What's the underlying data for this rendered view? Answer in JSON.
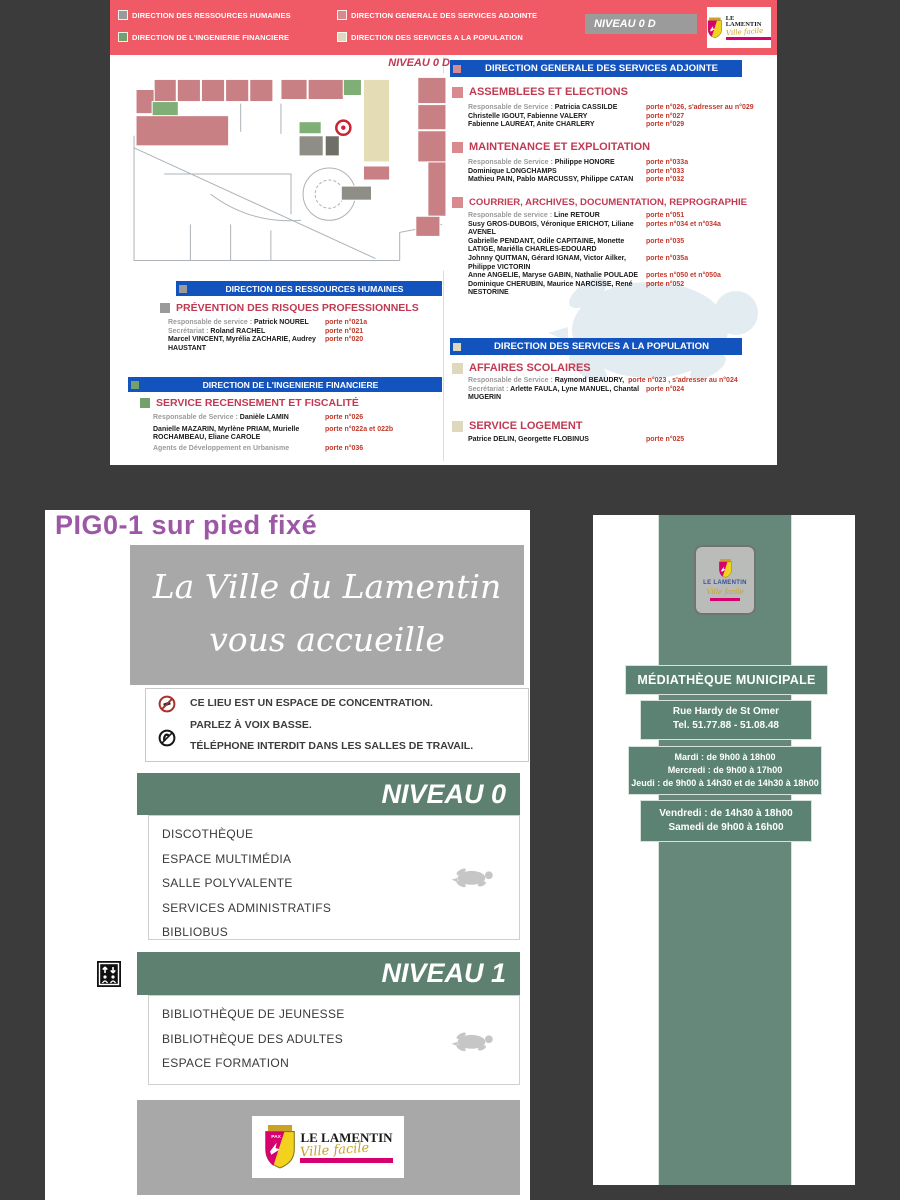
{
  "colors": {
    "background": "#3b3b3b",
    "banner_pink": "#ef5a66",
    "bar_blue": "#1353bd",
    "section_title_red": "#c13a52",
    "porte_red": "#c0392b",
    "sage_green_bar": "#5d8070",
    "totem_green": "#65887a",
    "gray_box": "#a8a8a8",
    "purple_title": "#9c57a5",
    "legend_gray": "#9a9a9a",
    "legend_rose": "#d98a8f",
    "legend_green": "#74a06b",
    "legend_beige": "#ded9bd",
    "logo_magenta": "#d6006e",
    "logo_gold": "#c9a227",
    "plan_pink": "#c88084",
    "plan_green": "#7fae77",
    "plan_beige": "#e3dcb4",
    "plan_gray": "#8e8e86"
  },
  "top": {
    "legend": [
      {
        "label": "DIRECTION DES RESSOURCES HUMAINES",
        "color": "#9a9a9a"
      },
      {
        "label": "DIRECTION GENERALE DES SERVICES ADJOINTE",
        "color": "#d98a8f"
      },
      {
        "label": "DIRECTION  DE L'INGENIERIE FINANCIERE",
        "color": "#74a06b"
      },
      {
        "label": "DIRECTION  DES SERVICES A LA POPULATION",
        "color": "#ded9bd"
      }
    ],
    "level_badge": "NIVEAU 0 D",
    "plan_title": "NIVEAU 0 D",
    "logo": {
      "name": "LE LAMENTIN",
      "tagline": "Ville facile"
    },
    "drh": {
      "header": "DIRECTION DES RESSOURCES HUMAINES",
      "service": {
        "title": "PRÉVENTION DES RISQUES PROFESSIONNELS",
        "rows": [
          {
            "label": "Responsable de service : ",
            "name": "Patrick NOUREL",
            "porte": "porte n°021a"
          },
          {
            "label": "Secrétariat : ",
            "name": "Roland RACHEL",
            "porte": "porte n°021"
          },
          {
            "name": "Marcel VINCENT, Myrélia ZACHARIE, Audrey HAUSTANT",
            "porte": "porte n°020"
          }
        ]
      }
    },
    "dif": {
      "header": "DIRECTION  DE L'INGENIERIE FINANCIERE",
      "service": {
        "title": "SERVICE RECENSEMENT ET FISCALITÉ",
        "rows": [
          {
            "label": "Responsable de Service : ",
            "name": "Danièle LAMIN",
            "porte": "porte n°026"
          },
          {
            "name": "Danielle MAZARIN, Myrlène PRIAM, Murielle ROCHAMBEAU, Eliane CAROLE",
            "porte": "porte n°022a et 022b"
          },
          {
            "name": "Agents de Développement en Urbanisme",
            "porte": "porte n°036"
          }
        ]
      }
    },
    "dgsa": {
      "header": "DIRECTION GENERALE DES SERVICES ADJOINTE",
      "services": [
        {
          "title": "ASSEMBLEES ET ELECTIONS",
          "rows": [
            {
              "label": "Responsable de Service : ",
              "name": "Patricia CASSILDE",
              "porte": "porte n°026, s'adresser au n°029"
            },
            {
              "name": "Christelle IGOUT, Fabienne VALERY",
              "porte": "porte n°027"
            },
            {
              "name": "Fabienne LAUREAT, Anite CHARLERY",
              "porte": "porte n°029"
            }
          ]
        },
        {
          "title": "MAINTENANCE ET EXPLOITATION",
          "rows": [
            {
              "label": "Responsable de Service : ",
              "name": "Philippe HONORE",
              "porte": "porte n°033a"
            },
            {
              "name": "Dominique LONGCHAMPS",
              "porte": "porte n°033"
            },
            {
              "name": "Mathieu PAIN, Pablo MARCUSSY, Philippe CATAN",
              "porte": "porte n°032"
            }
          ]
        },
        {
          "title": "COURRIER, ARCHIVES, DOCUMENTATION, REPROGRAPHIE",
          "rows": [
            {
              "label": "Responsable de service : ",
              "name": "Line RETOUR",
              "porte": "porte n°051"
            },
            {
              "name": "Susy GROS-DUBOIS, Véronique ERICHOT, Liliane AVENEL",
              "porte": "portes n°034 et n°034a"
            },
            {
              "name": "Gabrielle PENDANT, Odile CAPITAINE, Monette LATIGE, Mariélla CHARLES-EDOUARD",
              "porte": "porte n°035"
            },
            {
              "name": "Johnny QUITMAN, Gérard IGNAM, Victor Ailker, Philippe VICTORIN",
              "porte": "porte n°035a"
            },
            {
              "name": "Anne ANGELIE, Maryse GABIN, Nathalie POULADE",
              "porte": "portes n°050 et n°050a"
            },
            {
              "name": "Dominique CHERUBIN, Maurice NARCISSE, René NESTORINE",
              "porte": "porte n°052"
            }
          ]
        }
      ]
    },
    "dsp": {
      "header": "DIRECTION  DES SERVICES A LA POPULATION",
      "services": [
        {
          "title": "AFFAIRES SCOLAIRES",
          "rows": [
            {
              "label": "Responsable de Service : ",
              "name": "Raymond BEAUDRY,",
              "porte": "porte n°023 , s'adresser au n°024"
            },
            {
              "label": "Secrétariat : ",
              "name": "Arlette FAULA, Lyne MANUEL, Chantal MUGERIN",
              "porte": "porte n°024"
            }
          ]
        },
        {
          "title": "SERVICE LOGEMENT",
          "rows": [
            {
              "name": "Patrice DELIN, Georgette FLOBINUS",
              "porte": "porte n°025"
            }
          ]
        }
      ]
    }
  },
  "poster": {
    "title": "PIG0-1 sur pied fixé",
    "welcome": {
      "line1": "La Ville du Lamentin",
      "line2": "vous accueille"
    },
    "rules": [
      {
        "icon": "no-noise-icon",
        "text": "CE LIEU EST UN ESPACE DE CONCENTRATION."
      },
      {
        "text": "PARLEZ À VOIX BASSE."
      },
      {
        "icon": "no-phone-icon",
        "text": "TÉLÉPHONE INTERDIT DANS LES SALLES DE TRAVAIL."
      }
    ],
    "level0": {
      "label": "NIVEAU 0",
      "items": [
        "DISCOTHÈQUE",
        "ESPACE MULTIMÉDIA",
        "SALLE POLYVALENTE",
        "SERVICES ADMINISTRATIFS",
        "BIBLIOBUS"
      ]
    },
    "level1": {
      "label": "NIVEAU 1",
      "items": [
        "BIBLIOTHÈQUE DE JEUNESSE",
        "BIBLIOTHÈQUE DES ADULTES",
        "ESPACE FORMATION"
      ]
    },
    "footer_logo": {
      "name": "LE LAMENTIN",
      "tagline": "Ville facile"
    }
  },
  "totem": {
    "plaque": {
      "name": "LE LAMENTIN",
      "tagline": "Ville facile"
    },
    "name_band": "MÉDIATHÈQUE MUNICIPALE",
    "address": {
      "line1": "Rue Hardy de St Omer",
      "line2": "Tel. 51.77.88 - 51.08.48"
    },
    "hours1": [
      "Mardi : de 9h00 à 18h00",
      "Mercredi : de 9h00 à 17h00",
      "Jeudi : de 9h00 à 14h30 et de 14h30 à 18h00"
    ],
    "hours2": [
      "Vendredi : de 14h30 à 18h00",
      "Samedi de 9h00 à 16h00"
    ]
  }
}
